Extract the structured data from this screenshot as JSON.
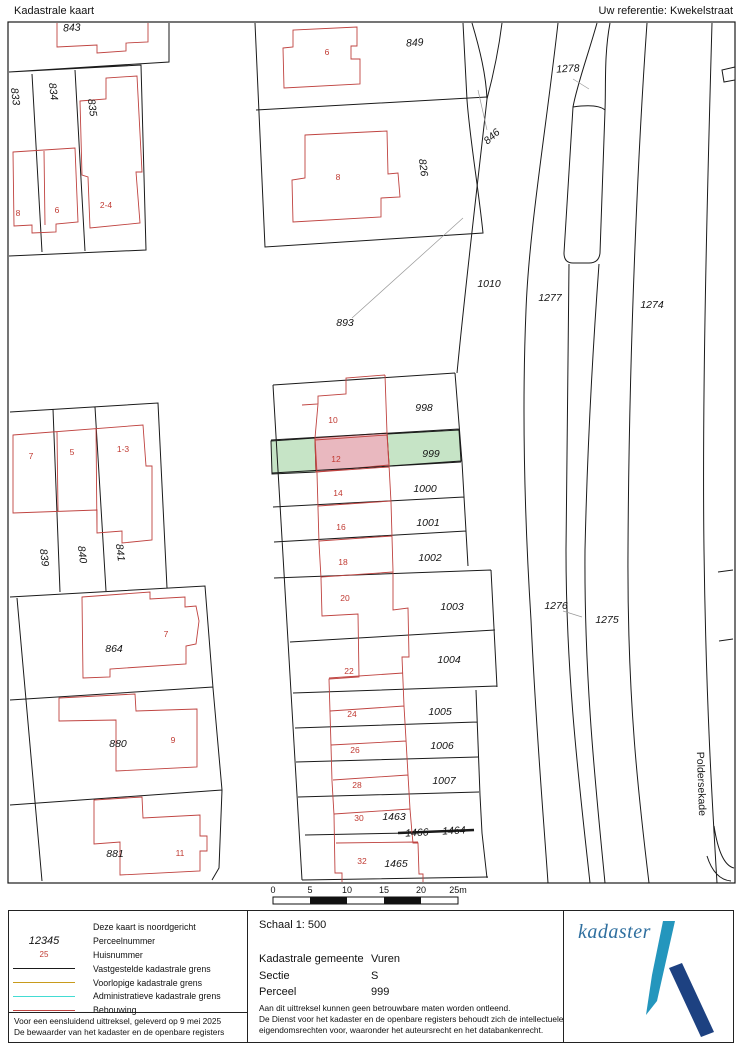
{
  "header": {
    "title": "Kadastrale kaart",
    "reference": "Uw referentie: Kwekelstraat"
  },
  "map": {
    "street_label": "Poldersekade",
    "highlight_colors": {
      "parcel_green": "#c6e4c6",
      "building_pink": "#e9b8bf",
      "building_red": "#bf4340"
    },
    "parcel_labels": [
      {
        "text": "843",
        "x": 72,
        "y": 31,
        "rot": -3
      },
      {
        "text": "833",
        "x": 12,
        "y": 97,
        "rot": 83
      },
      {
        "text": "834",
        "x": 50,
        "y": 92,
        "rot": 83
      },
      {
        "text": "835",
        "x": 89,
        "y": 108,
        "rot": 83
      },
      {
        "text": "849",
        "x": 415,
        "y": 46,
        "rot": -4
      },
      {
        "text": "826",
        "x": 420,
        "y": 168,
        "rot": 83
      },
      {
        "text": "846",
        "x": 494,
        "y": 139,
        "rot": -42
      },
      {
        "text": "893",
        "x": 345,
        "y": 326,
        "rot": 0
      },
      {
        "text": "1010",
        "x": 489,
        "y": 287,
        "rot": 0
      },
      {
        "text": "1278",
        "x": 568,
        "y": 72,
        "rot": -3
      },
      {
        "text": "1277",
        "x": 550,
        "y": 301,
        "rot": 0
      },
      {
        "text": "1274",
        "x": 652,
        "y": 308,
        "rot": 0
      },
      {
        "text": "1276",
        "x": 556,
        "y": 609,
        "rot": 0
      },
      {
        "text": "1275",
        "x": 607,
        "y": 623,
        "rot": 0
      },
      {
        "text": "998",
        "x": 424,
        "y": 411,
        "rot": 0
      },
      {
        "text": "999",
        "x": 431,
        "y": 457,
        "rot": 0
      },
      {
        "text": "1000",
        "x": 425,
        "y": 492,
        "rot": 0
      },
      {
        "text": "1001",
        "x": 428,
        "y": 526,
        "rot": 0
      },
      {
        "text": "1002",
        "x": 430,
        "y": 561,
        "rot": 0
      },
      {
        "text": "1003",
        "x": 452,
        "y": 610,
        "rot": 0
      },
      {
        "text": "1004",
        "x": 449,
        "y": 663,
        "rot": 0
      },
      {
        "text": "1005",
        "x": 440,
        "y": 715,
        "rot": 0
      },
      {
        "text": "1006",
        "x": 442,
        "y": 749,
        "rot": 0
      },
      {
        "text": "1007",
        "x": 444,
        "y": 784,
        "rot": 0
      },
      {
        "text": "1463",
        "x": 394,
        "y": 820,
        "rot": 0
      },
      {
        "text": "1466",
        "x": 417,
        "y": 836,
        "rot": -3
      },
      {
        "text": "1464",
        "x": 454,
        "y": 834,
        "rot": -3
      },
      {
        "text": "1465",
        "x": 396,
        "y": 867,
        "rot": 0
      },
      {
        "text": "864",
        "x": 114,
        "y": 652,
        "rot": 0
      },
      {
        "text": "839",
        "x": 41,
        "y": 558,
        "rot": 83
      },
      {
        "text": "840",
        "x": 79,
        "y": 555,
        "rot": 83
      },
      {
        "text": "841",
        "x": 117,
        "y": 553,
        "rot": 83
      },
      {
        "text": "880",
        "x": 118,
        "y": 747,
        "rot": 0
      },
      {
        "text": "881",
        "x": 115,
        "y": 857,
        "rot": 0
      }
    ],
    "house_numbers": [
      {
        "text": "8",
        "x": 18,
        "y": 216
      },
      {
        "text": "6",
        "x": 57,
        "y": 213
      },
      {
        "text": "2-4",
        "x": 106,
        "y": 208
      },
      {
        "text": "6",
        "x": 327,
        "y": 55
      },
      {
        "text": "8",
        "x": 338,
        "y": 180
      },
      {
        "text": "7",
        "x": 31,
        "y": 459
      },
      {
        "text": "5",
        "x": 72,
        "y": 455
      },
      {
        "text": "1-3",
        "x": 123,
        "y": 452
      },
      {
        "text": "7",
        "x": 166,
        "y": 637
      },
      {
        "text": "9",
        "x": 173,
        "y": 743
      },
      {
        "text": "11",
        "x": 180,
        "y": 856
      },
      {
        "text": "10",
        "x": 333,
        "y": 423
      },
      {
        "text": "12",
        "x": 336,
        "y": 462
      },
      {
        "text": "14",
        "x": 338,
        "y": 496
      },
      {
        "text": "16",
        "x": 341,
        "y": 530
      },
      {
        "text": "18",
        "x": 343,
        "y": 565
      },
      {
        "text": "20",
        "x": 345,
        "y": 601
      },
      {
        "text": "22",
        "x": 349,
        "y": 674
      },
      {
        "text": "24",
        "x": 352,
        "y": 717
      },
      {
        "text": "26",
        "x": 355,
        "y": 753
      },
      {
        "text": "28",
        "x": 357,
        "y": 788
      },
      {
        "text": "30",
        "x": 359,
        "y": 821
      },
      {
        "text": "32",
        "x": 362,
        "y": 864
      }
    ],
    "scale_bar": {
      "ticks": [
        "0",
        "5",
        "10",
        "15",
        "20",
        "25m"
      ]
    }
  },
  "legend": {
    "rows": [
      {
        "type": "none",
        "sample": "",
        "color": "",
        "label": "Deze kaart is noordgericht"
      },
      {
        "type": "parcel",
        "sample": "12345",
        "color": "",
        "label": "Perceelnummer"
      },
      {
        "type": "house",
        "sample": "25",
        "color": "",
        "label": "Huisnummer"
      },
      {
        "type": "line",
        "sample": "",
        "color": "#1a1a1a",
        "label": "Vastgestelde kadastrale grens"
      },
      {
        "type": "line",
        "sample": "",
        "color": "#c89b1c",
        "label": "Voorlopige kadastrale grens"
      },
      {
        "type": "line",
        "sample": "",
        "color": "#43dcd3",
        "label": "Administratieve kadastrale grens"
      },
      {
        "type": "line",
        "sample": "",
        "color": "#bf4340",
        "label": "Bebouwing"
      }
    ],
    "notes": [
      "Voor een eensluidend uittreksel, geleverd op 9 mei 2025",
      "De bewaarder van het kadaster en de openbare registers"
    ]
  },
  "details": {
    "schaal": "Schaal 1: 500",
    "gemeente_label": "Kadastrale gemeente",
    "gemeente_value": "Vuren",
    "sectie_label": "Sectie",
    "sectie_value": "S",
    "perceel_label": "Perceel",
    "perceel_value": "999",
    "notes": [
      "Aan dit uittreksel kunnen geen betrouwbare maten worden ontleend.",
      "De Dienst voor het kadaster en de openbare registers behoudt zich de intellectuele",
      "eigendomsrechten voor, waaronder het auteursrecht en het databankenrecht."
    ]
  },
  "logo": {
    "text": "kadaster",
    "word_color": "#2f6f9f",
    "light_color": "#2496bd",
    "dark_color": "#1d4181"
  }
}
